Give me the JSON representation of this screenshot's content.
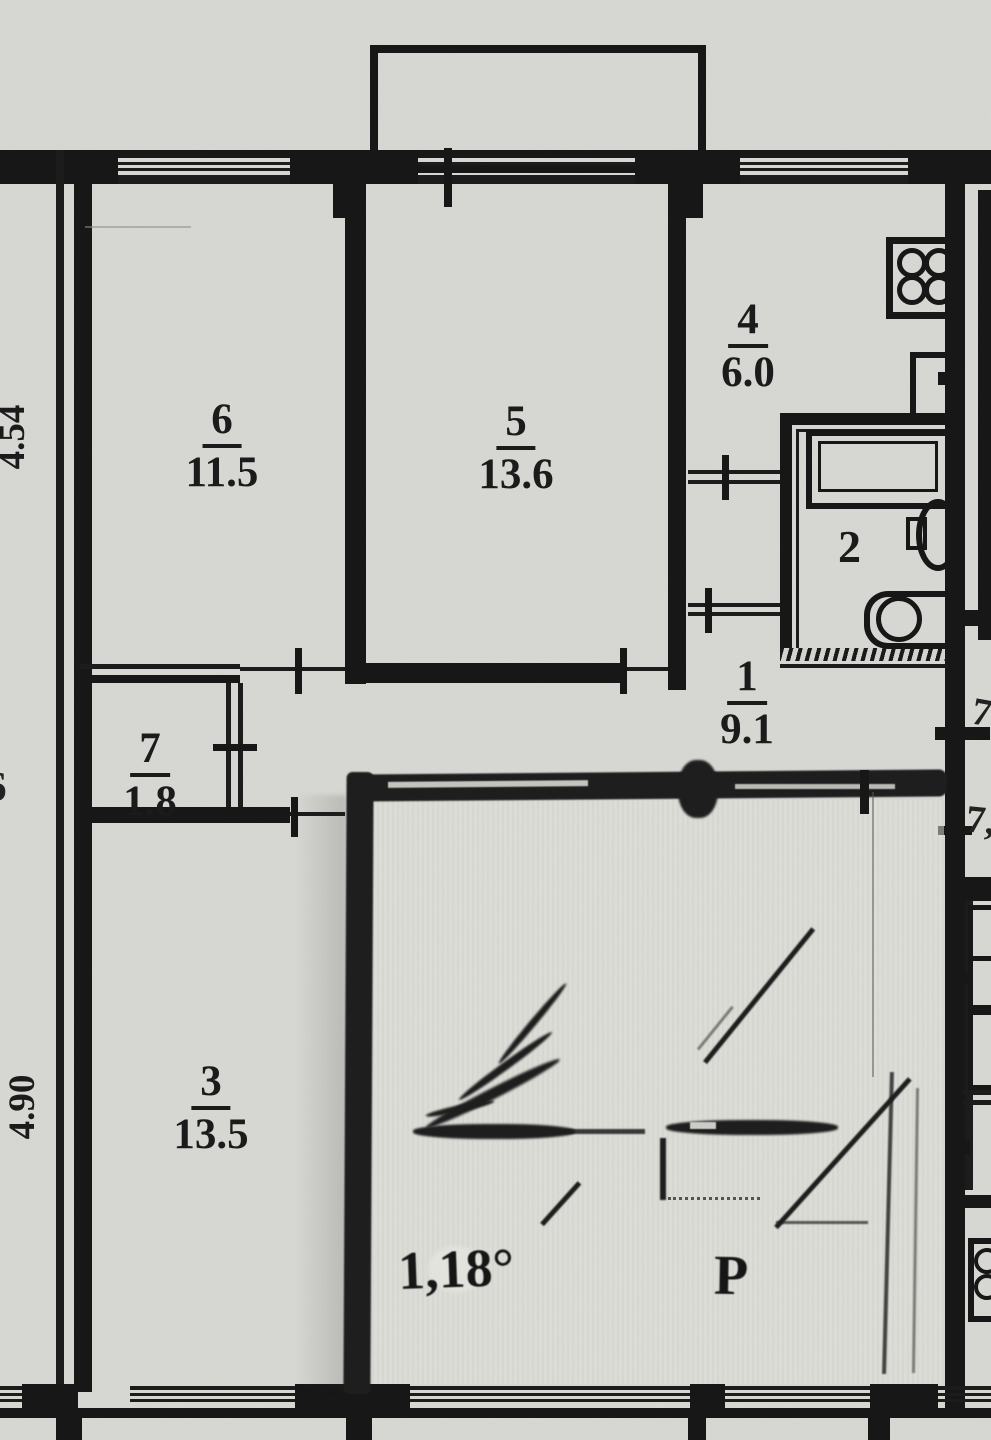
{
  "plan": {
    "type": "scanned apartment floor plan",
    "colors": {
      "paper": "#d9d9d5",
      "ink": "#171717",
      "smudge": "#1e1e1e"
    },
    "rooms": {
      "r6": {
        "num": "6",
        "area": "11.5"
      },
      "r5": {
        "num": "5",
        "area": "13.6"
      },
      "r4": {
        "num": "4",
        "area": "6.0"
      },
      "r2": {
        "num": "2"
      },
      "r1": {
        "num": "1",
        "area": "9.1"
      },
      "r7": {
        "num": "7",
        "area": "1.8"
      },
      "r3": {
        "num": "3",
        "area": "13.5"
      }
    },
    "dims": {
      "left_top": "4.54",
      "left_bottom": "4.90",
      "left_partial": "6",
      "right_partial_top": "7",
      "right_partial_bottom": "7,"
    },
    "marks": {
      "hand_measure": "1,18°",
      "hand_letter": "Р"
    },
    "fixtures": [
      "stove-4-burners",
      "kitchen-sink",
      "bathtub",
      "toilet",
      "washbasin",
      "neighbor-stove-partial"
    ]
  }
}
